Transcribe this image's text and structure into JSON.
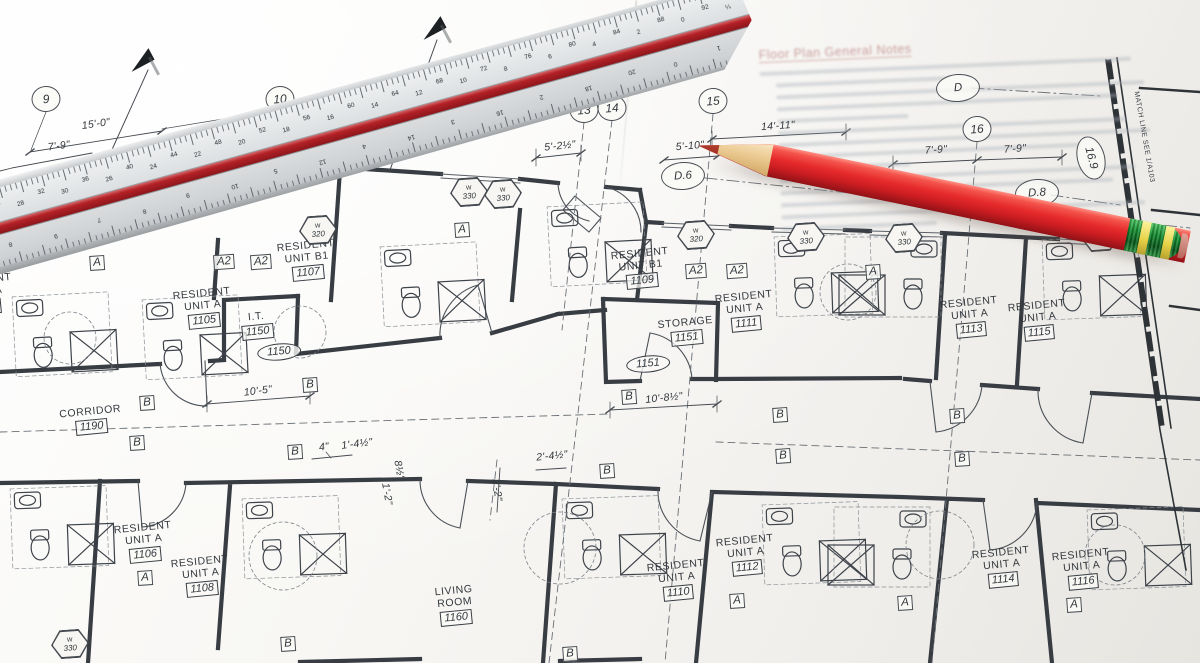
{
  "drawing": {
    "grid_bubbles": [
      {
        "label": "9",
        "x": 46,
        "y": 99
      },
      {
        "label": "10",
        "x": 280,
        "y": 99
      },
      {
        "label": "13",
        "x": 584,
        "y": 110
      },
      {
        "label": "14",
        "x": 612,
        "y": 108
      },
      {
        "label": "15",
        "x": 713,
        "y": 101
      },
      {
        "label": "16",
        "x": 977,
        "y": 129
      },
      {
        "label": "D",
        "x": 958,
        "y": 88,
        "oval": true
      },
      {
        "label": "D.6",
        "x": 683,
        "y": 176,
        "oval": true
      },
      {
        "label": "D.8",
        "x": 1037,
        "y": 193,
        "oval": true
      },
      {
        "label": "16.9",
        "x": 1091,
        "y": 158,
        "oval": true,
        "rot": 75
      }
    ],
    "dimensions": [
      {
        "text": "15'-0\"",
        "x": 96,
        "y": 124,
        "rot": -8
      },
      {
        "text": "7'-9\"",
        "x": 59,
        "y": 146,
        "rot": -8
      },
      {
        "text": "7'-9\"",
        "x": -14,
        "y": 144,
        "rot": -8
      },
      {
        "text": "5'-2½\"",
        "x": 560,
        "y": 146,
        "rot": -6
      },
      {
        "text": "5'-10\"",
        "x": 690,
        "y": 146,
        "rot": -5
      },
      {
        "text": "14'-11\"",
        "x": 778,
        "y": 126,
        "rot": -4
      },
      {
        "text": "7'-9\"",
        "x": 936,
        "y": 150,
        "rot": -4
      },
      {
        "text": "7'-9\"",
        "x": 1015,
        "y": 149,
        "rot": -4
      },
      {
        "text": "10'-5\"",
        "x": 258,
        "y": 391,
        "rot": -7
      },
      {
        "text": "10'-8½\"",
        "x": 664,
        "y": 398,
        "rot": -6
      },
      {
        "text": "4\"",
        "x": 324,
        "y": 447,
        "rot": -7
      },
      {
        "text": "1'-4½\"",
        "x": 357,
        "y": 444,
        "rot": -7
      },
      {
        "text": "2'-4½\"",
        "x": 552,
        "y": 456,
        "rot": -6
      },
      {
        "text": "2'-2\"",
        "x": 497,
        "y": 490,
        "rot": 82
      },
      {
        "text": "1'-2\"",
        "x": 387,
        "y": 494,
        "rot": 80
      },
      {
        "text": "8½\"",
        "x": 399,
        "y": 470,
        "rot": 80
      }
    ],
    "rooms": [
      {
        "lines": [
          "RESIDENT",
          "UNIT A"
        ],
        "number": "1103",
        "x": -16,
        "y": 294
      },
      {
        "lines": [
          "RESIDENT",
          "UNIT A"
        ],
        "number": "1105",
        "x": 203,
        "y": 308
      },
      {
        "lines": [
          "RESIDENT",
          "UNIT B1"
        ],
        "number": "1107",
        "x": 307,
        "y": 260
      },
      {
        "lines": [
          "I.T."
        ],
        "number": "1150",
        "x": 257,
        "y": 325
      },
      {
        "lines": [
          "RESIDENT",
          "UNIT B1"
        ],
        "number": "1109",
        "x": 641,
        "y": 268
      },
      {
        "lines": [
          "STORAGE"
        ],
        "number": "1151",
        "x": 686,
        "y": 331
      },
      {
        "lines": [
          "RESIDENT",
          "UNIT A"
        ],
        "number": "1111",
        "x": 745,
        "y": 311
      },
      {
        "lines": [
          "RESIDENT",
          "UNIT A"
        ],
        "number": "1113",
        "x": 970,
        "y": 317
      },
      {
        "lines": [
          "RESIDENT",
          "UNIT A"
        ],
        "number": "1115",
        "x": 1038,
        "y": 320
      },
      {
        "lines": [
          "CORRIDOR"
        ],
        "number": "1190",
        "x": 91,
        "y": 420
      },
      {
        "lines": [
          "RESIDENT",
          "UNIT A"
        ],
        "number": "1106",
        "x": 144,
        "y": 542
      },
      {
        "lines": [
          "RESIDENT",
          "UNIT A"
        ],
        "number": "1108",
        "x": 201,
        "y": 576
      },
      {
        "lines": [
          "LIVING",
          "ROOM"
        ],
        "number": "1160",
        "x": 455,
        "y": 605
      },
      {
        "lines": [
          "RESIDENT",
          "UNIT A"
        ],
        "number": "1110",
        "x": 677,
        "y": 580
      },
      {
        "lines": [
          "RESIDENT",
          "UNIT A"
        ],
        "number": "1112",
        "x": 746,
        "y": 555
      },
      {
        "lines": [
          "RESIDENT",
          "UNIT A"
        ],
        "number": "1114",
        "x": 1002,
        "y": 567
      },
      {
        "lines": [
          "RESIDENT",
          "UNIT A"
        ],
        "number": "1116",
        "x": 1082,
        "y": 569
      }
    ],
    "oval_tags": [
      {
        "number": "1150",
        "x": 279,
        "y": 352
      },
      {
        "number": "1151",
        "x": 648,
        "y": 364
      }
    ],
    "letter_markers": [
      {
        "letter": "A",
        "x": 97,
        "y": 263
      },
      {
        "letter": "A",
        "x": 462,
        "y": 230
      },
      {
        "letter": "A",
        "x": 873,
        "y": 272
      },
      {
        "letter": "A",
        "x": 145,
        "y": 578
      },
      {
        "letter": "A",
        "x": 737,
        "y": 601
      },
      {
        "letter": "A",
        "x": 905,
        "y": 603
      },
      {
        "letter": "A",
        "x": 1074,
        "y": 605
      },
      {
        "letter": "A2",
        "x": 224,
        "y": 262
      },
      {
        "letter": "A2",
        "x": 261,
        "y": 262
      },
      {
        "letter": "A2",
        "x": 696,
        "y": 271
      },
      {
        "letter": "A2",
        "x": 737,
        "y": 271
      },
      {
        "letter": "B",
        "x": 310,
        "y": 385
      },
      {
        "letter": "B",
        "x": 147,
        "y": 403
      },
      {
        "letter": "B",
        "x": 137,
        "y": 443
      },
      {
        "letter": "B",
        "x": 295,
        "y": 452
      },
      {
        "letter": "B",
        "x": 629,
        "y": 397
      },
      {
        "letter": "B",
        "x": 780,
        "y": 415
      },
      {
        "letter": "B",
        "x": 783,
        "y": 456
      },
      {
        "letter": "B",
        "x": 607,
        "y": 471
      },
      {
        "letter": "B",
        "x": 957,
        "y": 416
      },
      {
        "letter": "B",
        "x": 962,
        "y": 459
      },
      {
        "letter": "B",
        "x": 288,
        "y": 644
      },
      {
        "letter": "B",
        "x": 570,
        "y": 654
      }
    ],
    "window_tags": [
      {
        "code": "W",
        "number": "320",
        "x": 318,
        "y": 230
      },
      {
        "code": "W",
        "number": "330",
        "x": 469,
        "y": 192
      },
      {
        "code": "W",
        "number": "330",
        "x": 503,
        "y": 194
      },
      {
        "code": "W",
        "number": "320",
        "x": 696,
        "y": 235
      },
      {
        "code": "W",
        "number": "330",
        "x": 806,
        "y": 237
      },
      {
        "code": "W",
        "number": "330",
        "x": 904,
        "y": 238
      },
      {
        "code": "W",
        "number": "320",
        "x": 1100,
        "y": 237
      },
      {
        "code": "W",
        "number": "330",
        "x": 70,
        "y": 644
      }
    ],
    "flags": [
      {
        "x": 140,
        "y": 60,
        "rot": -28
      },
      {
        "x": 432,
        "y": 28,
        "rot": -28
      }
    ],
    "match_line": {
      "text": "MATCH LINE SEE 1/A103",
      "x": 1144,
      "y": 137,
      "rot": 80
    },
    "notes": {
      "heading": "Floor Plan General Notes",
      "lines": [
        {
          "w": 96,
          "ind": 0
        },
        {
          "w": 44,
          "ind": 4
        },
        {
          "w": 95,
          "ind": 4
        },
        {
          "w": 88,
          "ind": 4
        },
        {
          "w": 34,
          "ind": 4
        },
        {
          "w": 90,
          "ind": 4
        },
        {
          "w": 96,
          "ind": 4
        },
        {
          "w": 78,
          "ind": 4
        },
        {
          "w": 30,
          "ind": 8
        },
        {
          "w": 92,
          "ind": 4
        },
        {
          "w": 86,
          "ind": 4
        },
        {
          "w": 58,
          "ind": 4
        },
        {
          "w": 94,
          "ind": 4
        },
        {
          "w": 40,
          "ind": 4
        }
      ]
    }
  },
  "ruler": {
    "top_scale_numbers": [
      "34",
      "28",
      "32",
      "30",
      "36",
      "26",
      "40",
      "24",
      "44",
      "22",
      "48",
      "20",
      "52",
      "18",
      "56",
      "16",
      "60",
      "14",
      "64",
      "12",
      "68",
      "10",
      "72",
      "8",
      "76",
      "6",
      "80",
      "4",
      "84",
      "2",
      "88",
      "0",
      "92",
      "¼"
    ],
    "front_scale_numbers": [
      "8",
      "9",
      "7",
      "8",
      "9",
      "10",
      "5",
      "12",
      "4",
      "14",
      "3",
      "16",
      "2",
      "18",
      "20",
      "0",
      "1"
    ]
  },
  "colors": {
    "paper": "#f6f5f2",
    "line": "#3d4248",
    "ruler_body": "#dcdee0",
    "ruler_stripe": "#b32126",
    "pencil_red": "#e02828",
    "pencil_wood": "#e8cda2",
    "ferrule_green": "#1d8a33",
    "band_yellow": "#ecdc55"
  }
}
